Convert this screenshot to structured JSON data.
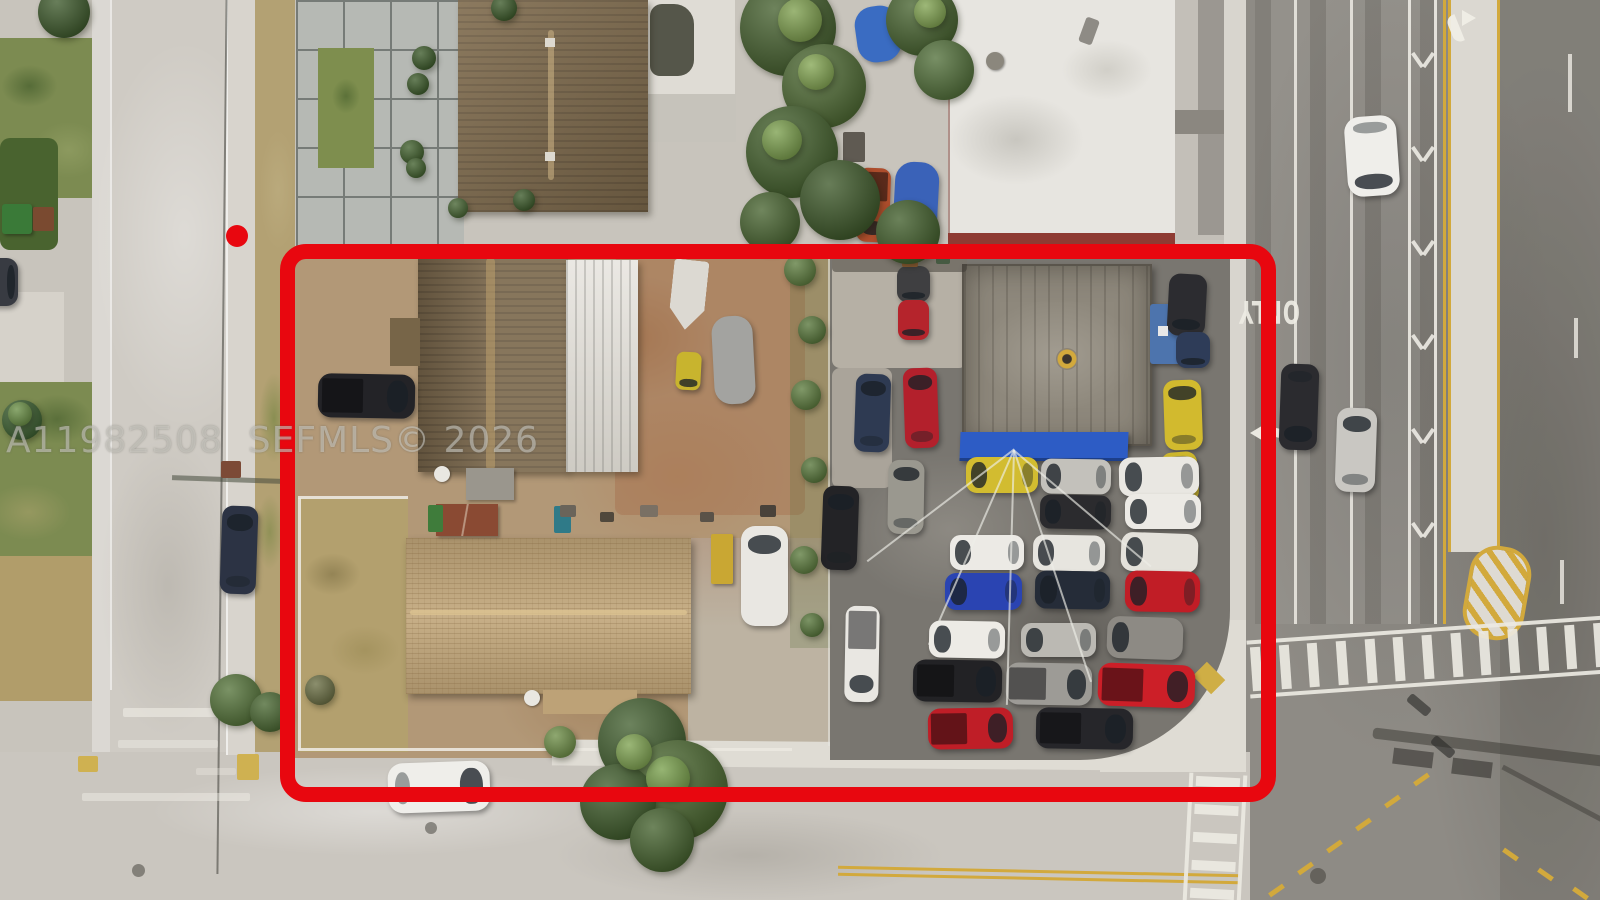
{
  "scene": {
    "description": "Aerial drone photo of a corner property outlined in red, with two houses, a used-car lot full of vehicles, neighboring buildings and a multi-lane road with intersection",
    "watermark": "A11982508  SEFMLS© 2026",
    "road_text": "ONLY",
    "outline_color": "#e8070f",
    "road_marking_color": "#edebE4",
    "yellow_marking_color": "#d2a93c"
  },
  "cars": [
    {
      "x": 897,
      "y": 266,
      "w": 33,
      "h": 36,
      "c": "#3f3f41",
      "g": "s",
      "t": "suv",
      "r": 0
    },
    {
      "x": 898,
      "y": 300,
      "w": 31,
      "h": 40,
      "c": "#b5242c",
      "g": "s",
      "t": "suv",
      "r": 0
    },
    {
      "x": 855,
      "y": 374,
      "w": 35,
      "h": 78,
      "c": "#2e3a52",
      "g": "n",
      "t": "car",
      "r": 2
    },
    {
      "x": 904,
      "y": 368,
      "w": 34,
      "h": 80,
      "c": "#b3202c",
      "g": "n",
      "t": "car",
      "r": -2
    },
    {
      "x": 888,
      "y": 460,
      "w": 36,
      "h": 74,
      "c": "#9a988f",
      "g": "n",
      "t": "car",
      "r": 1
    },
    {
      "x": 822,
      "y": 486,
      "w": 36,
      "h": 84,
      "c": "#232326",
      "g": "n",
      "t": "car",
      "r": 2
    },
    {
      "x": 845,
      "y": 606,
      "w": 34,
      "h": 96,
      "c": "#e9e7e2",
      "g": "s",
      "t": "pickup",
      "bed": "n",
      "r": 1
    },
    {
      "x": 1168,
      "y": 274,
      "w": 38,
      "h": 62,
      "c": "#2c2c30",
      "g": "s",
      "t": "suv",
      "r": 3
    },
    {
      "x": 1176,
      "y": 332,
      "w": 34,
      "h": 36,
      "c": "#2e3c58",
      "g": "s",
      "t": "suv",
      "r": 0
    },
    {
      "x": 1164,
      "y": 380,
      "w": 38,
      "h": 70,
      "c": "#d2ba2e",
      "g": "n",
      "t": "car",
      "r": -2
    },
    {
      "x": 1162,
      "y": 452,
      "w": 36,
      "h": 50,
      "c": "#cdb62c",
      "g": "s",
      "t": "car",
      "r": -4
    },
    {
      "x": 966,
      "y": 457,
      "w": 72,
      "h": 36,
      "c": "#d2bc30",
      "g": "w",
      "t": "car",
      "r": 0
    },
    {
      "x": 1041,
      "y": 459,
      "w": 70,
      "h": 35,
      "c": "#c3c1bb",
      "g": "w",
      "t": "car",
      "r": 1
    },
    {
      "x": 1119,
      "y": 457,
      "w": 80,
      "h": 39,
      "c": "#e9e7e2",
      "g": "w",
      "t": "car",
      "r": -1
    },
    {
      "x": 1040,
      "y": 495,
      "w": 71,
      "h": 34,
      "c": "#2b2b2e",
      "g": "w",
      "t": "car",
      "r": 1
    },
    {
      "x": 1125,
      "y": 494,
      "w": 76,
      "h": 35,
      "c": "#eceae5",
      "g": "w",
      "t": "car",
      "r": 0
    },
    {
      "x": 950,
      "y": 535,
      "w": 74,
      "h": 35,
      "c": "#eceae5",
      "g": "w",
      "t": "car",
      "r": 0
    },
    {
      "x": 1033,
      "y": 535,
      "w": 72,
      "h": 36,
      "c": "#e7e5df",
      "g": "w",
      "t": "car",
      "r": 1
    },
    {
      "x": 1121,
      "y": 533,
      "w": 77,
      "h": 39,
      "c": "#e4e2db",
      "g": "w",
      "t": "suv",
      "r": 2
    },
    {
      "x": 945,
      "y": 573,
      "w": 77,
      "h": 37,
      "c": "#2a44b2",
      "g": "w",
      "t": "car",
      "r": 0
    },
    {
      "x": 1035,
      "y": 571,
      "w": 75,
      "h": 38,
      "c": "#252c38",
      "g": "w",
      "t": "car",
      "r": 1
    },
    {
      "x": 1125,
      "y": 571,
      "w": 75,
      "h": 41,
      "c": "#c11d26",
      "g": "w",
      "t": "car",
      "r": 1
    },
    {
      "x": 929,
      "y": 621,
      "w": 76,
      "h": 37,
      "c": "#edebe6",
      "g": "w",
      "t": "car",
      "r": 1
    },
    {
      "x": 1021,
      "y": 623,
      "w": 75,
      "h": 34,
      "c": "#bbb9b3",
      "g": "w",
      "t": "car",
      "r": 0
    },
    {
      "x": 1107,
      "y": 617,
      "w": 76,
      "h": 42,
      "c": "#8d8a84",
      "g": "w",
      "t": "suv",
      "r": 2
    },
    {
      "x": 913,
      "y": 660,
      "w": 89,
      "h": 42,
      "c": "#222225",
      "g": "e",
      "t": "pickup",
      "bed": "w",
      "r": 1
    },
    {
      "x": 1006,
      "y": 663,
      "w": 86,
      "h": 42,
      "c": "#9d9b96",
      "g": "e",
      "t": "pickup",
      "bed": "w",
      "r": 1
    },
    {
      "x": 1098,
      "y": 664,
      "w": 97,
      "h": 43,
      "c": "#cc1f28",
      "g": "e",
      "t": "pickup",
      "bed": "w",
      "r": 2
    },
    {
      "x": 928,
      "y": 708,
      "w": 85,
      "h": 41,
      "c": "#bf1e27",
      "g": "e",
      "t": "pickup",
      "bed": "w",
      "r": -1
    },
    {
      "x": 1036,
      "y": 708,
      "w": 97,
      "h": 41,
      "c": "#26262a",
      "g": "e",
      "t": "pickup",
      "bed": "w",
      "r": 1
    },
    {
      "x": 1346,
      "y": 116,
      "w": 52,
      "h": 80,
      "c": "#efeeea",
      "g": "s",
      "t": "car",
      "r": -4
    },
    {
      "x": 1280,
      "y": 364,
      "w": 38,
      "h": 86,
      "c": "#2b2b2f",
      "g": "s",
      "t": "car",
      "r": 2
    },
    {
      "x": 1336,
      "y": 408,
      "w": 40,
      "h": 84,
      "c": "#c9c7c2",
      "g": "n",
      "t": "car",
      "r": 2
    },
    {
      "x": 221,
      "y": 506,
      "w": 36,
      "h": 88,
      "c": "#2c3344",
      "g": "n",
      "t": "car",
      "r": 2
    },
    {
      "x": 388,
      "y": 762,
      "w": 102,
      "h": 50,
      "c": "#efeeea",
      "g": "e",
      "t": "car",
      "r": -2
    },
    {
      "x": -20,
      "y": 258,
      "w": 38,
      "h": 48,
      "c": "#383b42",
      "g": "e",
      "t": "car",
      "r": 0
    },
    {
      "x": 318,
      "y": 374,
      "w": 97,
      "h": 44,
      "c": "#232327",
      "g": "e",
      "t": "pickup",
      "bed": "w",
      "r": 1
    },
    {
      "x": 713,
      "y": 316,
      "w": 41,
      "h": 88,
      "c": "#a3a3a0",
      "g": "",
      "t": "blob",
      "r": -3
    },
    {
      "x": 741,
      "y": 526,
      "w": 47,
      "h": 100,
      "c": "#e9e7e2",
      "g": "n",
      "t": "van",
      "r": 0
    },
    {
      "x": 676,
      "y": 352,
      "w": 25,
      "h": 38,
      "c": "#c8b42e",
      "g": "s",
      "t": "suv",
      "r": 3
    },
    {
      "x": 857,
      "y": 168,
      "w": 33,
      "h": 74,
      "c": "#ad4d2c",
      "g": "s",
      "t": "pickup",
      "bed": "n",
      "r": 2
    },
    {
      "x": 894,
      "y": 162,
      "w": 44,
      "h": 80,
      "c": "#3a62b8",
      "g": "",
      "t": "blob",
      "r": 3
    },
    {
      "x": 856,
      "y": 6,
      "w": 44,
      "h": 56,
      "c": "#3a6cc2",
      "g": "",
      "t": "blob",
      "r": -8
    },
    {
      "x": 920,
      "y": 48,
      "w": 14,
      "h": 18,
      "c": "#c8a62e",
      "g": "",
      "t": "blob",
      "r": 0
    },
    {
      "x": 671,
      "y": 260,
      "w": 35,
      "h": 70,
      "c": "#dcd9d2",
      "g": "",
      "t": "boat",
      "r": 6
    }
  ],
  "trees": [
    {
      "x": 788,
      "y": 28,
      "r": 48,
      "c": "#45602e"
    },
    {
      "x": 824,
      "y": 86,
      "r": 42,
      "c": "#4e6a33"
    },
    {
      "x": 792,
      "y": 152,
      "r": 46,
      "c": "#43602c"
    },
    {
      "x": 840,
      "y": 200,
      "r": 40,
      "c": "#3d5829"
    },
    {
      "x": 922,
      "y": 20,
      "r": 36,
      "c": "#47632f"
    },
    {
      "x": 944,
      "y": 70,
      "r": 30,
      "c": "#52703a"
    },
    {
      "x": 908,
      "y": 232,
      "r": 32,
      "c": "#415e2b"
    },
    {
      "x": 770,
      "y": 222,
      "r": 30,
      "c": "#486430"
    },
    {
      "x": 800,
      "y": 20,
      "r": 22,
      "c": "#7fa04f"
    },
    {
      "x": 816,
      "y": 72,
      "r": 18,
      "c": "#85a754"
    },
    {
      "x": 782,
      "y": 140,
      "r": 20,
      "c": "#7ca04e"
    },
    {
      "x": 930,
      "y": 12,
      "r": 16,
      "c": "#82a452"
    },
    {
      "x": 642,
      "y": 742,
      "r": 44,
      "c": "#436030"
    },
    {
      "x": 678,
      "y": 790,
      "r": 50,
      "c": "#4a672f"
    },
    {
      "x": 618,
      "y": 802,
      "r": 38,
      "c": "#3f5c2b"
    },
    {
      "x": 662,
      "y": 840,
      "r": 32,
      "c": "#45622e"
    },
    {
      "x": 668,
      "y": 778,
      "r": 22,
      "c": "#79a04c"
    },
    {
      "x": 634,
      "y": 752,
      "r": 18,
      "c": "#7fa351"
    },
    {
      "x": 236,
      "y": 700,
      "r": 26,
      "c": "#55743a"
    },
    {
      "x": 270,
      "y": 712,
      "r": 20,
      "c": "#4a6832"
    },
    {
      "x": 424,
      "y": 58,
      "r": 12,
      "c": "#3c5a2a"
    },
    {
      "x": 418,
      "y": 84,
      "r": 11,
      "c": "#3c5a2a"
    },
    {
      "x": 412,
      "y": 152,
      "r": 12,
      "c": "#41602d"
    },
    {
      "x": 416,
      "y": 168,
      "r": 10,
      "c": "#41602d"
    },
    {
      "x": 504,
      "y": 8,
      "r": 13,
      "c": "#3c5a2a"
    },
    {
      "x": 524,
      "y": 200,
      "r": 11,
      "c": "#3c5a2a"
    },
    {
      "x": 458,
      "y": 208,
      "r": 10,
      "c": "#466432"
    },
    {
      "x": 22,
      "y": 420,
      "r": 20,
      "c": "#3c6030"
    },
    {
      "x": 20,
      "y": 414,
      "r": 12,
      "c": "#6a8f46"
    },
    {
      "x": 64,
      "y": 12,
      "r": 26,
      "c": "#3e5a2c"
    },
    {
      "x": 800,
      "y": 270,
      "r": 16,
      "c": "#5d7c3e"
    },
    {
      "x": 812,
      "y": 330,
      "r": 14,
      "c": "#57763a"
    },
    {
      "x": 806,
      "y": 395,
      "r": 15,
      "c": "#5d7c3e"
    },
    {
      "x": 814,
      "y": 470,
      "r": 13,
      "c": "#57763a"
    },
    {
      "x": 804,
      "y": 560,
      "r": 14,
      "c": "#5d7c3e"
    },
    {
      "x": 812,
      "y": 625,
      "r": 12,
      "c": "#57763a"
    },
    {
      "x": 320,
      "y": 690,
      "r": 15,
      "c": "#6b6f44"
    },
    {
      "x": 560,
      "y": 742,
      "r": 16,
      "c": "#6f8f48"
    }
  ],
  "junk": [
    {
      "x": 560,
      "y": 505,
      "w": 16,
      "h": 12,
      "c": "#6a645a"
    },
    {
      "x": 600,
      "y": 512,
      "w": 14,
      "h": 10,
      "c": "#50483c"
    },
    {
      "x": 640,
      "y": 505,
      "w": 18,
      "h": 12,
      "c": "#7a7064"
    },
    {
      "x": 700,
      "y": 512,
      "w": 14,
      "h": 10,
      "c": "#5a5248"
    },
    {
      "x": 760,
      "y": 505,
      "w": 16,
      "h": 12,
      "c": "#49423a"
    },
    {
      "x": 843,
      "y": 132,
      "w": 22,
      "h": 30,
      "c": "#5f5a52"
    },
    {
      "x": 902,
      "y": 255,
      "w": 16,
      "h": 12,
      "c": "#8a5a32"
    },
    {
      "x": 936,
      "y": 252,
      "w": 14,
      "h": 12,
      "c": "#465a42"
    }
  ],
  "chevrons_y": [
    58,
    152,
    246,
    340,
    434,
    528
  ],
  "yellow_dashes": [
    {
      "x": 1268,
      "y": 888,
      "r": -35
    },
    {
      "x": 1297,
      "y": 866,
      "r": -35
    },
    {
      "x": 1326,
      "y": 844,
      "r": -35
    },
    {
      "x": 1355,
      "y": 822,
      "r": -35
    },
    {
      "x": 1384,
      "y": 799,
      "r": -35
    },
    {
      "x": 1413,
      "y": 777,
      "r": -35
    },
    {
      "x": 1502,
      "y": 852,
      "r": 35
    },
    {
      "x": 1537,
      "y": 872,
      "r": 35
    },
    {
      "x": 1572,
      "y": 891,
      "r": 35
    }
  ],
  "white_dashes": [
    {
      "x": 1568,
      "y": 54,
      "h": 58
    },
    {
      "x": 1574,
      "y": 318,
      "h": 40
    },
    {
      "x": 1560,
      "y": 560,
      "h": 44
    }
  ],
  "crosswalks": [
    {
      "x": 1248,
      "y": 628,
      "w": 360,
      "h": 58,
      "rot": -4,
      "n": 13,
      "bars": "v"
    },
    {
      "x": 1186,
      "y": 774,
      "w": 58,
      "h": 128,
      "rot": 3,
      "n": 5,
      "bars": "h"
    }
  ],
  "faded_marks": [
    {
      "x": 123,
      "y": 708,
      "w": 95,
      "h": 9,
      "o": 0.5
    },
    {
      "x": 118,
      "y": 740,
      "w": 100,
      "h": 8,
      "o": 0.38
    },
    {
      "x": 82,
      "y": 793,
      "w": 168,
      "h": 8,
      "o": 0.42
    },
    {
      "x": 196,
      "y": 768,
      "w": 40,
      "h": 7,
      "o": 0.3
    },
    {
      "x": 78,
      "y": 756,
      "w": 20,
      "h": 16,
      "o": 0.9,
      "c": "#cfae45"
    },
    {
      "x": 237,
      "y": 754,
      "w": 22,
      "h": 26,
      "o": 0.9,
      "c": "#cfae45"
    }
  ],
  "wires": [
    {
      "x": 1015,
      "y": 450,
      "len": 185,
      "rot": 142.7
    },
    {
      "x": 1015,
      "y": 450,
      "len": 213,
      "rot": 113.6
    },
    {
      "x": 1015,
      "y": 450,
      "len": 255,
      "rot": 91.6
    },
    {
      "x": 1015,
      "y": 450,
      "len": 244,
      "rot": 71.6
    },
    {
      "x": 1015,
      "y": 450,
      "len": 179,
      "rot": 40.3
    }
  ],
  "manholes": [
    {
      "x": 1310,
      "y": 868,
      "d": 16
    },
    {
      "x": 132,
      "y": 864,
      "d": 13
    },
    {
      "x": 425,
      "y": 822,
      "d": 12
    }
  ]
}
